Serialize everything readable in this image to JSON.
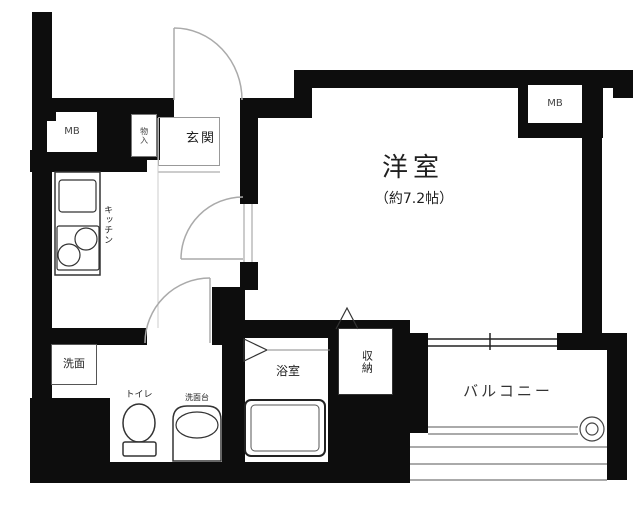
{
  "rooms": {
    "main_room": {
      "label": "洋室",
      "size": "（約7.2帖）"
    },
    "entrance": {
      "label": "玄関"
    },
    "kitchen": {
      "label": "キッチン"
    },
    "washroom": {
      "label": "洗面"
    },
    "toilet": {
      "label": "トイレ"
    },
    "vanity": {
      "label": "洗面台"
    },
    "bathroom": {
      "label": "浴室"
    },
    "storage": {
      "label": "収納"
    },
    "hall_closet": {
      "label": "物入"
    },
    "balcony": {
      "label": "バルコニー"
    },
    "meter_box_left": {
      "label": "MB"
    },
    "meter_box_right": {
      "label": "MB"
    }
  },
  "colors": {
    "wall": "#0d0d0d",
    "fixture_line": "#333333",
    "door_arc": "#aaaaaa",
    "text": "#1f1f1f"
  }
}
